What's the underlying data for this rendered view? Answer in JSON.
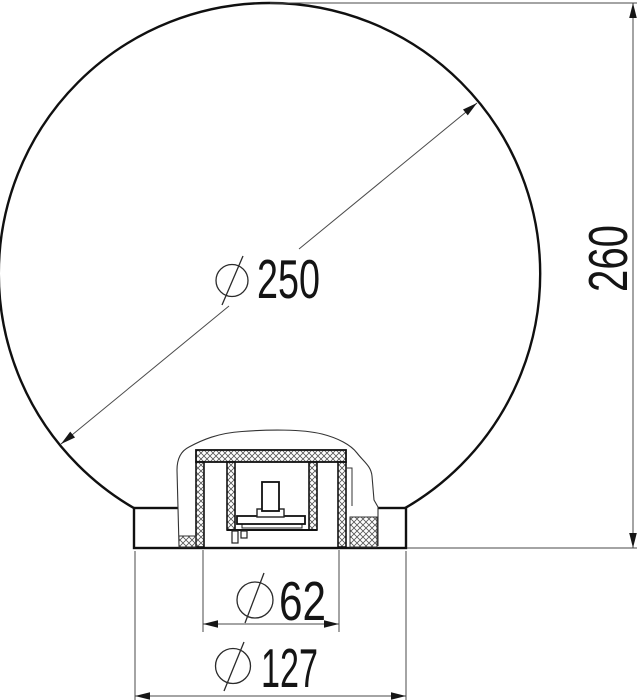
{
  "drawing": {
    "colors": {
      "background": "#ffffff",
      "main_line": "#101010",
      "thin_line": "#4a4a4a"
    },
    "dimensions": {
      "sphere_diameter": {
        "symbol": "⌀",
        "value": "250"
      },
      "overall_height": {
        "value": "260"
      },
      "neck_diameter": {
        "symbol": "⌀",
        "value": "62"
      },
      "base_diameter": {
        "symbol": "⌀",
        "value": "127"
      }
    }
  }
}
